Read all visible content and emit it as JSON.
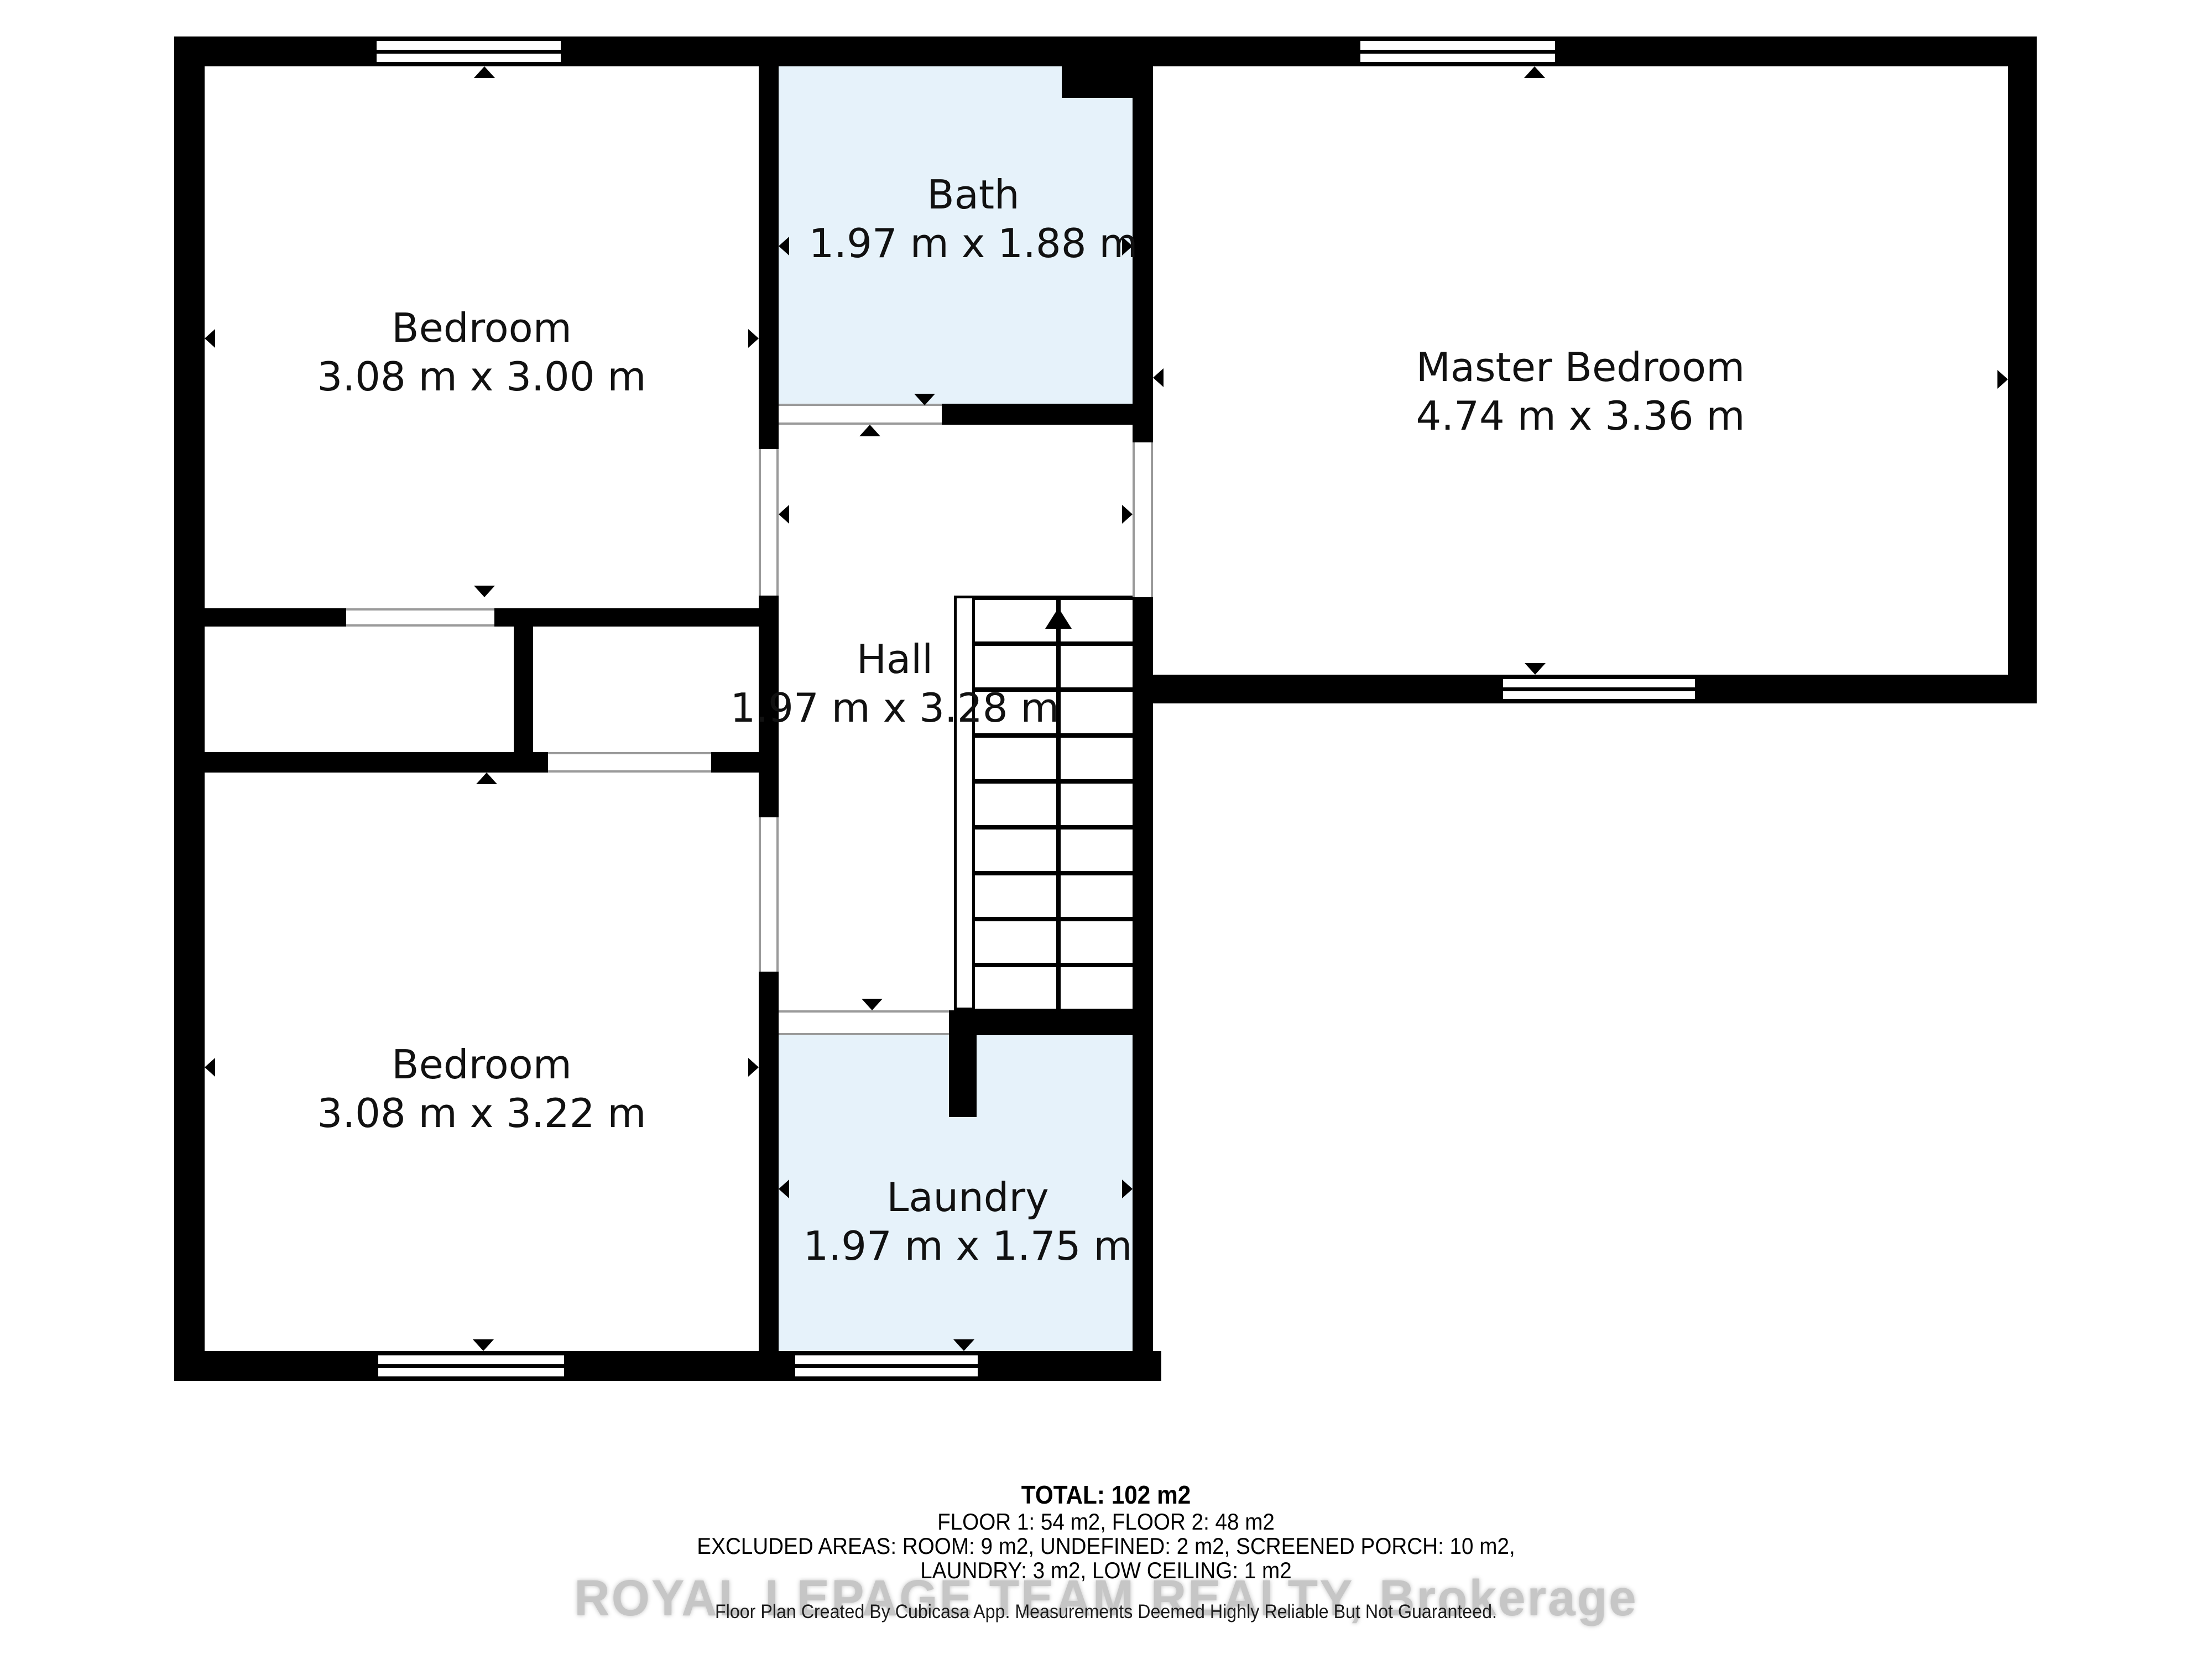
{
  "rooms": {
    "bedroom1": {
      "name": "Bedroom",
      "dims": "3.08 m x 3.00 m"
    },
    "bath": {
      "name": "Bath",
      "dims": "1.97 m x 1.88 m"
    },
    "master": {
      "name": "Master Bedroom",
      "dims": "4.74 m x 3.36 m"
    },
    "hall": {
      "name": "Hall",
      "dims": "1.97 m x 3.28 m"
    },
    "bedroom2": {
      "name": "Bedroom",
      "dims": "3.08 m x 3.22 m"
    },
    "laundry": {
      "name": "Laundry",
      "dims": "1.97 m x 1.75 m"
    }
  },
  "footer": {
    "total": "TOTAL: 102 m2",
    "floors": "FLOOR 1: 54 m2, FLOOR 2: 48 m2",
    "excluded_line1": "EXCLUDED AREAS: ROOM: 9 m2, UNDEFINED: 2 m2, SCREENED PORCH: 10 m2,",
    "excluded_line2": "LAUNDRY: 3 m2, LOW CEILING: 1 m2",
    "disclaimer": "Floor Plan Created By Cubicasa App. Measurements Deemed Highly Reliable But Not Guaranteed."
  },
  "watermark": "ROYAL LEPAGE TEAM REALTY, Brokerage",
  "colors": {
    "wall": "#000000",
    "wet_room_fill": "#e6f2fa",
    "watermark": "#c6c6c6",
    "opening_line": "#9a9a9a"
  }
}
